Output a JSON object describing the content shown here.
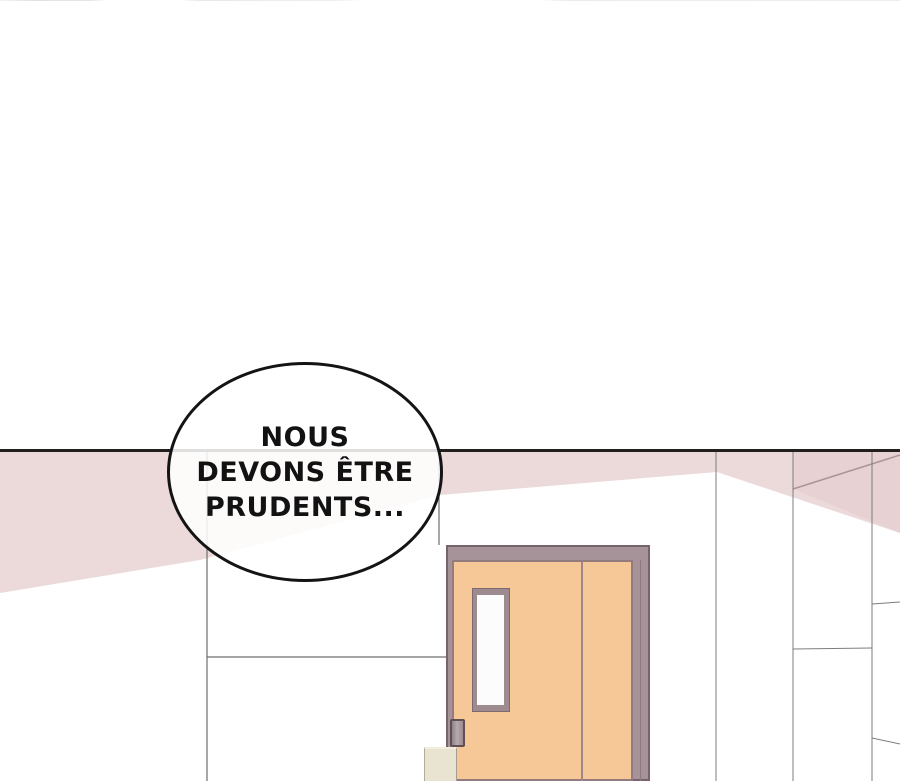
{
  "panel": {
    "speech_bubble": {
      "lines": [
        "NOUS",
        "DEVONS ÊTRE",
        "PRUDENTS..."
      ]
    },
    "colors": {
      "background": "#ffffff",
      "ceiling_line": "#241f1f",
      "ceiling_shadow_pink": "#ecd9da",
      "corner_shadow_pink": "#e7d1d3",
      "wall_seam_gray": "#7d7d7d",
      "door_panel_orange": "#f7c897",
      "door_frame_mauve": "#a6939a",
      "door_window_glass": "#fcfcfc",
      "door_handle_gray": "#9a8c90",
      "bin_beige": "#e8e4d1",
      "bubble_outline": "#141414",
      "bubble_fill": "#ffffff"
    }
  }
}
